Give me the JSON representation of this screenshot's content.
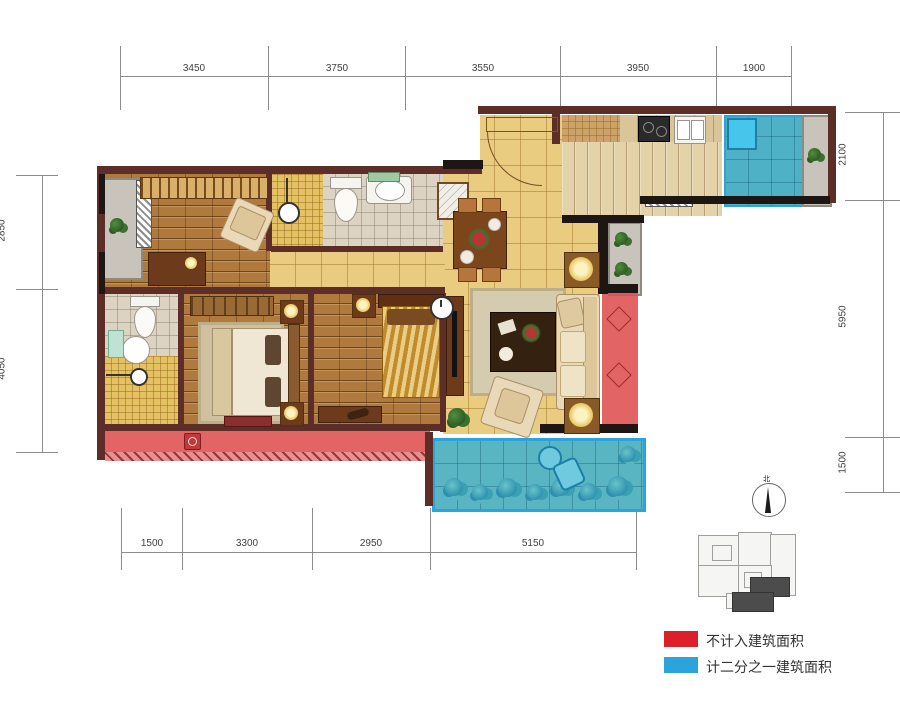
{
  "dimensions": {
    "top": [
      "3450",
      "3750",
      "3550",
      "3950",
      "1900"
    ],
    "bottom": [
      "1500",
      "3300",
      "2950",
      "5150"
    ],
    "left": [
      "2850",
      "4050"
    ],
    "right": [
      "2100",
      "5950",
      "1500"
    ]
  },
  "legend": {
    "items": [
      {
        "label": "不计入建筑面积",
        "color": "#dd1f2a"
      },
      {
        "label": "计二分之一建筑面积",
        "color": "#2ba3dd"
      }
    ]
  },
  "compass": {
    "label": "北"
  },
  "colors": {
    "wall": "#5d2d28",
    "wall_dark": "#1d1613",
    "floor_tile": "#e9cc80",
    "floor_wood": "#b07a3e",
    "balcony_excluded": "#dd1f2a",
    "balcony_half": "#2ba3dd"
  }
}
